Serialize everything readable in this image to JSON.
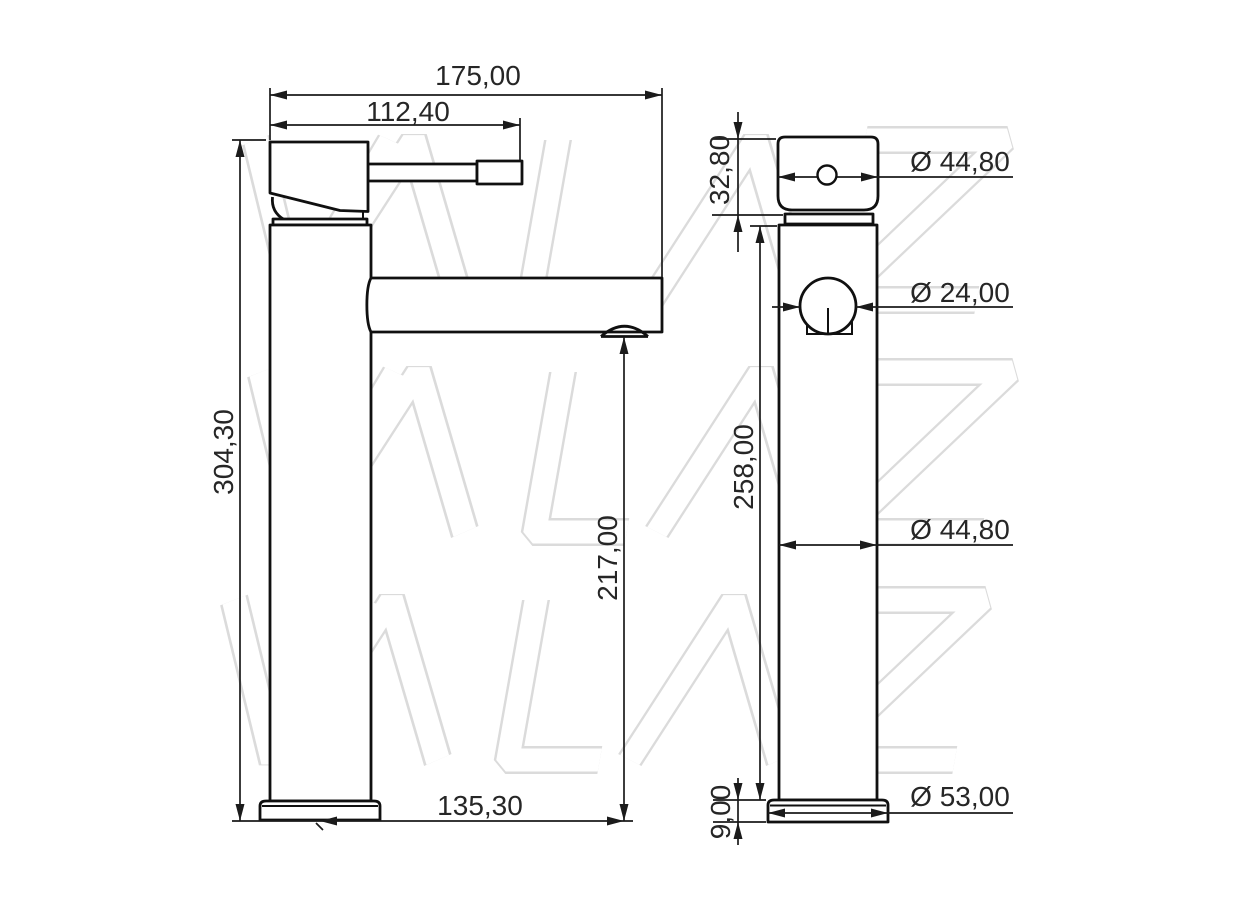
{
  "drawing": {
    "watermark_text": "VALAZ",
    "side_view": {
      "total_width": "175,00",
      "handle_reach": "112,40",
      "total_height": "304,30",
      "spout_height": "217,00",
      "spout_reach": "135,30"
    },
    "front_view": {
      "head_height": "32,80",
      "head_diameter": "Ø 44,80",
      "outlet_diameter": "Ø 24,00",
      "body_height": "258,00",
      "body_diameter": "Ø 44,80",
      "base_height": "9,00",
      "base_diameter": "Ø 53,00"
    },
    "colors": {
      "object_line": "#101010",
      "dimension_line": "#1b1b1b",
      "text": "#262626",
      "watermark_stroke": "#dbdbdb",
      "background": "#ffffff"
    }
  }
}
